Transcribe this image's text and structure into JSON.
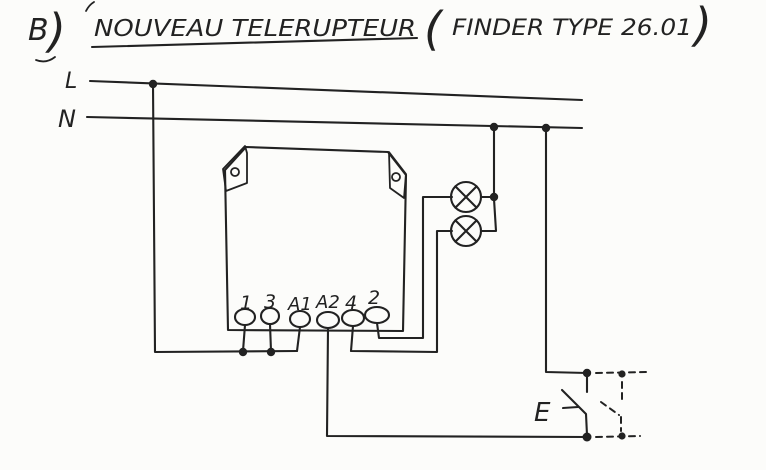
{
  "title": {
    "index": "B",
    "index_paren": ")",
    "main": "NOUVEAU TELERUPTEUR",
    "paren_open": "(",
    "subtitle": "FINDER TYPE 26.01",
    "paren_close": ")"
  },
  "supply": {
    "line_label": "L",
    "neutral_label": "N"
  },
  "device": {
    "terminals": [
      "1",
      "3",
      "A1",
      "A2",
      "4",
      "2"
    ]
  },
  "pushbutton": {
    "label": "E"
  },
  "colors": {
    "ink": "#222222",
    "paper": "#fcfcfa"
  }
}
